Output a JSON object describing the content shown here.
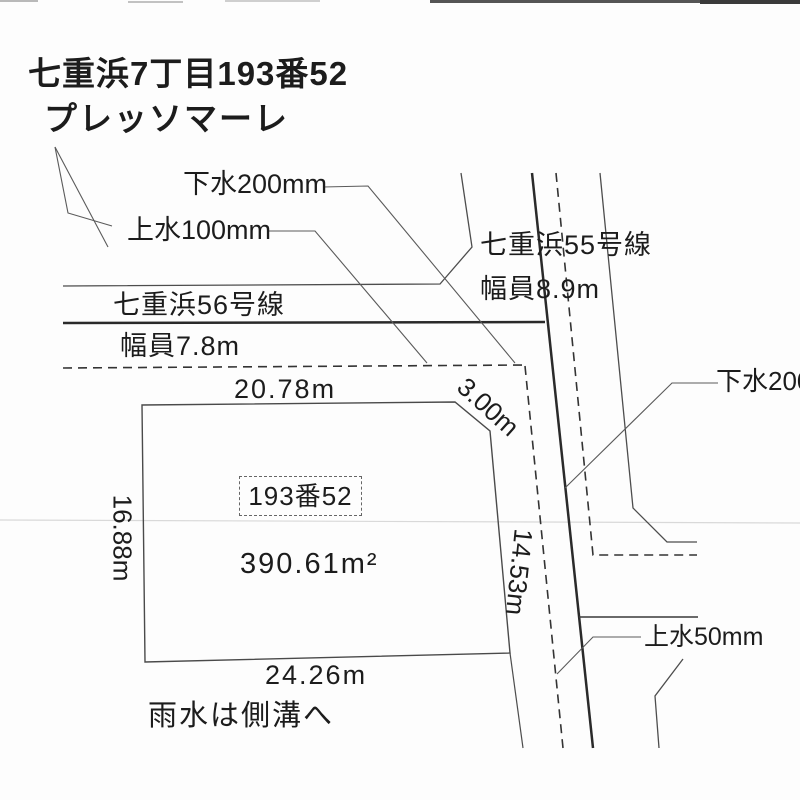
{
  "document": {
    "type": "land-survey-diagram",
    "title_line1": "七重浜7丁目193番52",
    "title_line2": "プレッソマーレ"
  },
  "parcel": {
    "lot_number": "193番52",
    "area": "390.61m²",
    "dimensions": {
      "top": "20.78m",
      "corner_bevel": "3.00m",
      "left": "16.88m",
      "right": "14.53m",
      "bottom": "24.26m"
    },
    "drainage_note": "雨水は側溝へ"
  },
  "roads": {
    "road56": {
      "name": "七重浜56号線",
      "width": "幅員7.8m"
    },
    "road55": {
      "name": "七重浜55号線",
      "width": "幅員8.9m"
    }
  },
  "utilities": {
    "sewer_main": "下水200mm",
    "water_main": "上水100mm",
    "sewer_right": "下水200mm",
    "water_right": "上水50mm"
  },
  "colors": {
    "paper": "#fdfdfd",
    "ink_thick": "#2a2a2a",
    "ink_thin": "#4d4d4d",
    "leader": "#5a5a5a",
    "scan_line": "#d9d9d9"
  }
}
